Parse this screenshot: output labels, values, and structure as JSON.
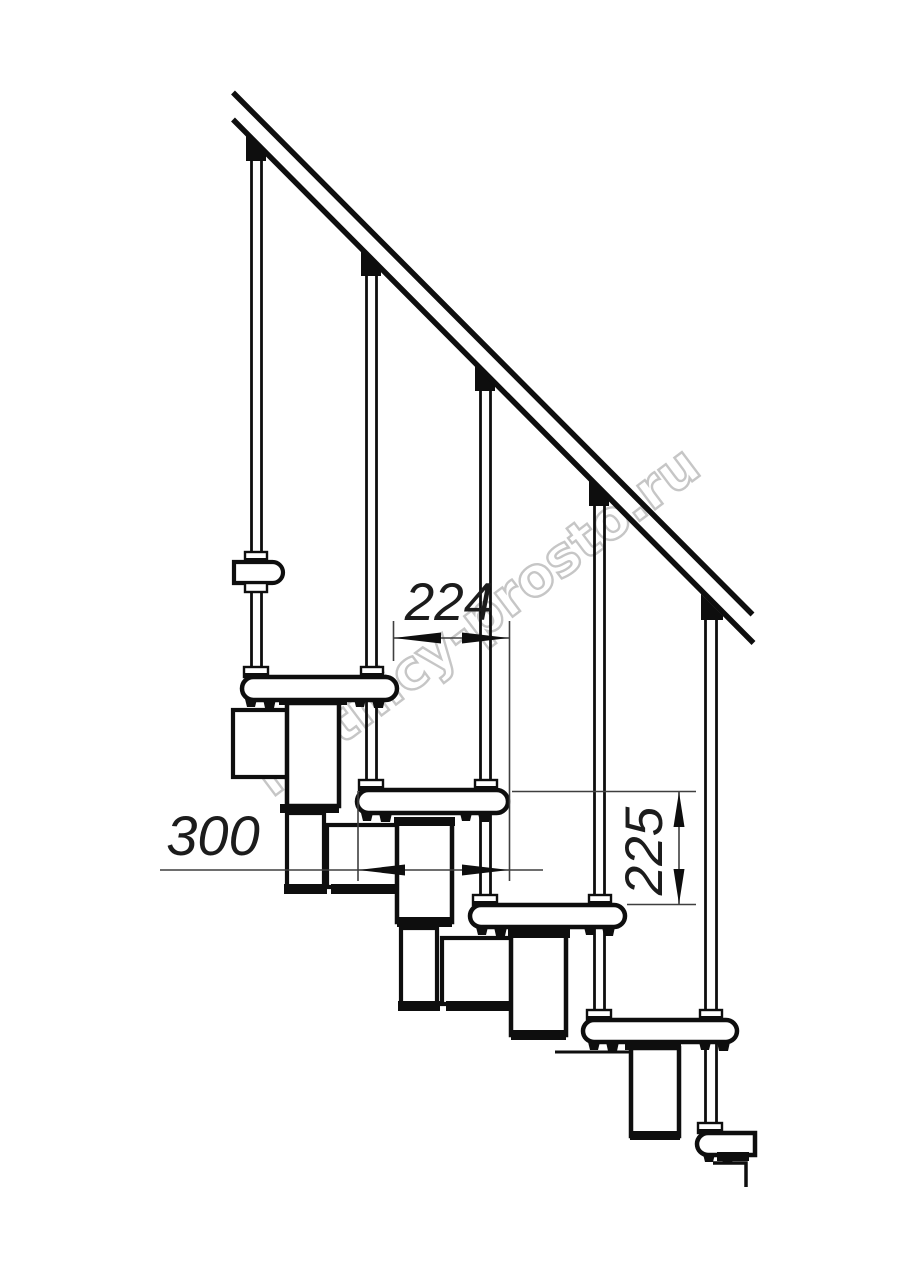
{
  "drawing": {
    "type": "technical-drawing",
    "view": "side elevation fragment of a modular staircase with handrail",
    "baluster_count": 5,
    "tread_count_visible": 6,
    "support_module_count": 4
  },
  "dimensions": {
    "going": {
      "value": "224",
      "orientation": "horizontal"
    },
    "tread_depth": {
      "value": "300",
      "orientation": "horizontal"
    },
    "rise": {
      "value": "225",
      "orientation": "vertical"
    }
  },
  "watermark": {
    "text": "lestnicy-prosto.ru",
    "color": "#c3c3c3"
  },
  "colors": {
    "background": "#ffffff",
    "line": "#0e0e0e",
    "dimension_line": "#3f3f3f",
    "dimension_text": "#1c1c1c"
  }
}
